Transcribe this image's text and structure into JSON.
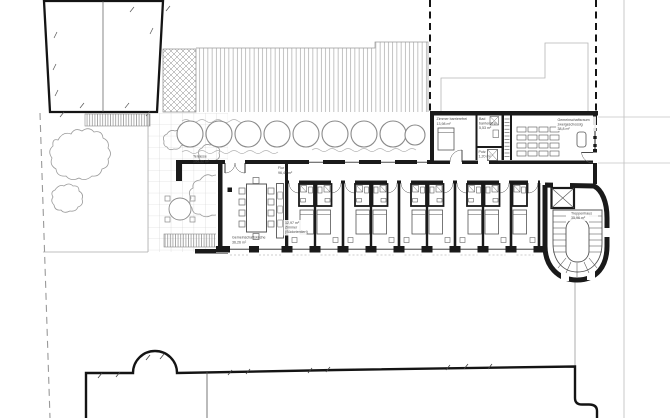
{
  "plan": {
    "labels": {
      "terrasse": {
        "line1": "Terrasse",
        "line2": "195,32 m²"
      },
      "flur": {
        "line1": "Flur",
        "line2": "96,47 m²"
      },
      "kueche": {
        "line1": "Gemeinschaftsküche",
        "line2": "36,26 m²"
      },
      "zimmer_sued": {
        "line1": "12,97 m²",
        "line2": "Zimmer",
        "line3": "(Südorientiert)"
      },
      "zimmer_bf": {
        "line1": "Zimmer barrierefrei",
        "line2": "13,98 m²"
      },
      "bad_bf": {
        "line1": "Bad",
        "line2": "barrierefrei",
        "line3": "5,53 m²"
      },
      "putz": {
        "line1": "Putz",
        "line2": "1,20 m²"
      },
      "gemeinschaftsraum": {
        "line1": "Gemeinschaftsraum",
        "line2": "zweigeschossig",
        "line3": "38,8 m²"
      },
      "treppenhaus": {
        "line1": "Treppenhaus",
        "line2": "35,96 m²"
      }
    },
    "colors": {
      "ink": "#1a1a1a",
      "muted": "#9a9a9a",
      "paper": "#ffffff"
    }
  }
}
